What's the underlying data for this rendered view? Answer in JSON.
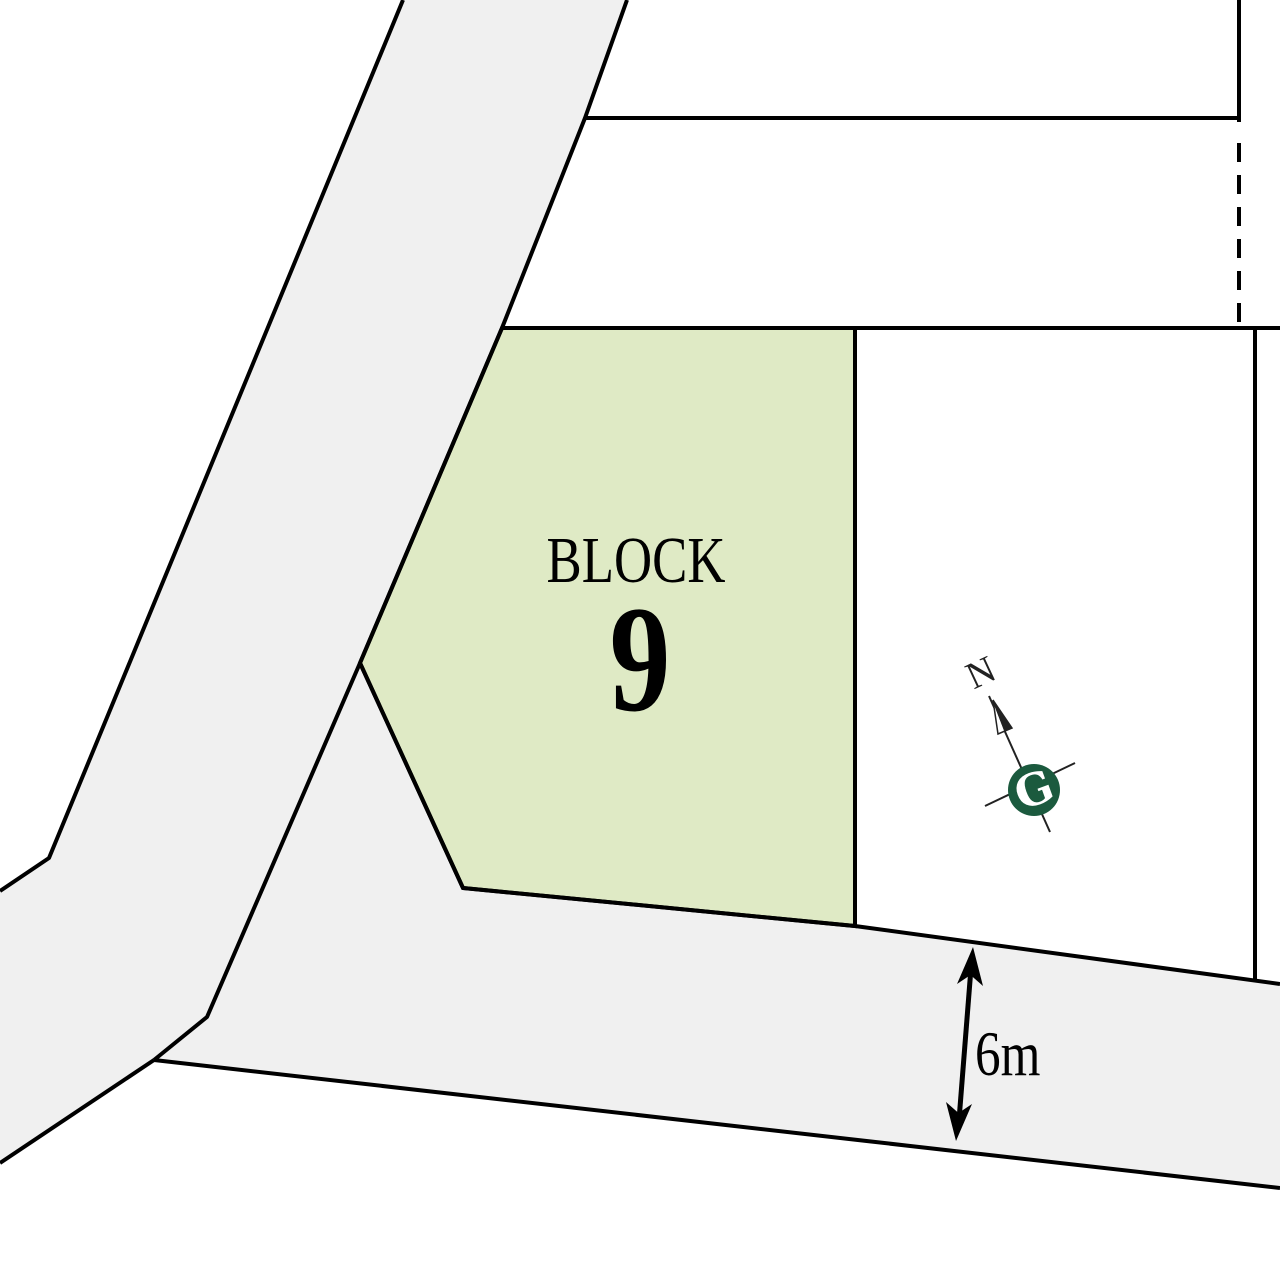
{
  "map": {
    "block": {
      "label": "BLOCK",
      "number": "9"
    },
    "road_width": {
      "value": "6m"
    },
    "compass": {
      "north_label": "N",
      "logo_letter": "G"
    },
    "colors": {
      "background": "#ffffff",
      "road_fill": "#f0f0f0",
      "block_fill": "#dfeac5",
      "outline": "#000000",
      "compass_green": "#1b5a3e",
      "compass_line": "#222222"
    }
  }
}
